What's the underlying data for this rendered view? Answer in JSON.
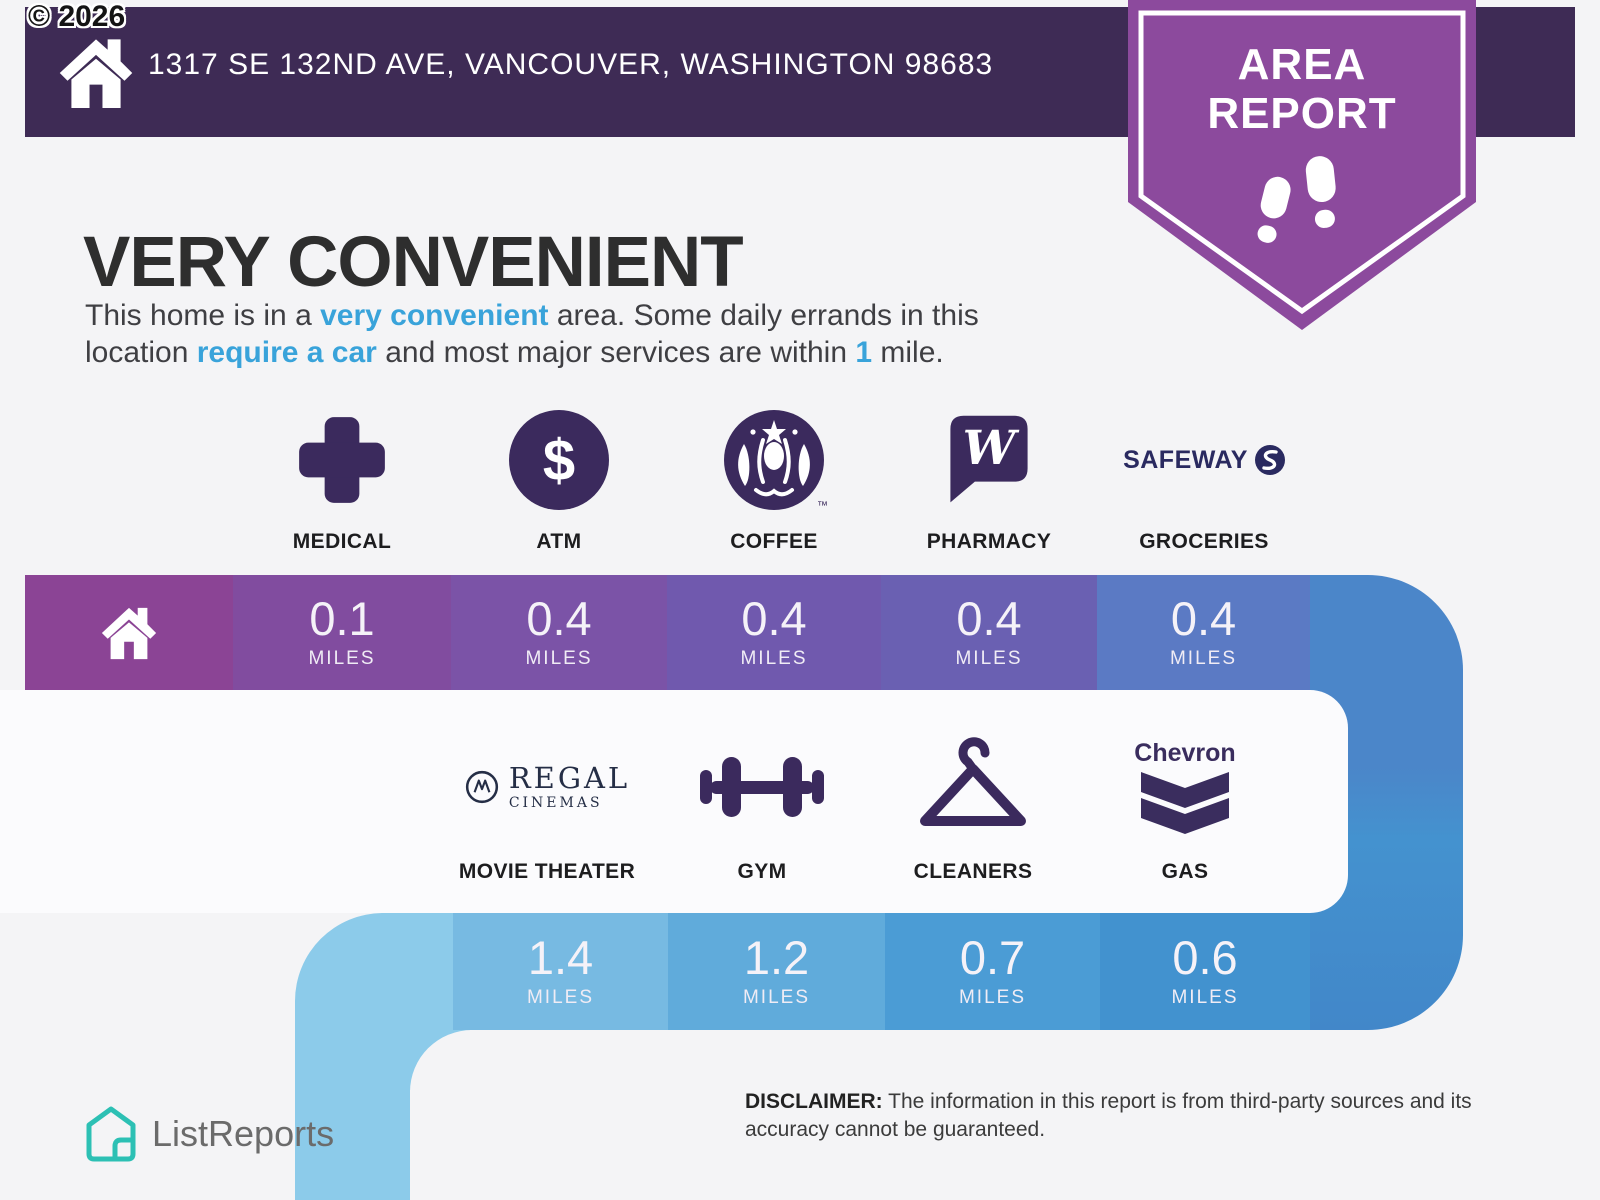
{
  "copyright": "© 2026",
  "header": {
    "address": "1317 SE 132ND AVE, VANCOUVER, WASHINGTON 98683"
  },
  "badge": {
    "line1": "AREA",
    "line2": "REPORT"
  },
  "main": {
    "title": "VERY CONVENIENT",
    "description": {
      "p1": "This home is in a ",
      "hl1": "very convenient",
      "p2": " area. Some daily errands in this",
      "p3": "location ",
      "hl2": "require a car",
      "p4": " and most major services are within ",
      "hl3": "1",
      "p5": " mile."
    }
  },
  "row1": {
    "home_cell_color": "#8b4495",
    "items": [
      {
        "label": "MEDICAL",
        "value": "0.1",
        "unit": "MILES",
        "icon": "medical-cross-icon",
        "cell_color": "#814c9f"
      },
      {
        "label": "ATM",
        "value": "0.4",
        "unit": "MILES",
        "icon": "dollar-circle-icon",
        "cell_color": "#7b53a7"
      },
      {
        "label": "COFFEE",
        "value": "0.4",
        "unit": "MILES",
        "icon": "starbucks-siren-icon",
        "cell_color": "#7059ae"
      },
      {
        "label": "PHARMACY",
        "value": "0.4",
        "unit": "MILES",
        "icon": "walgreens-w-icon",
        "cell_color": "#6a60b2"
      },
      {
        "label": "GROCERIES",
        "value": "0.4",
        "unit": "MILES",
        "icon": "safeway-logo-icon",
        "cell_color": "#5b7ac4"
      }
    ]
  },
  "row2": {
    "corner_color": "#8ccbea",
    "items": [
      {
        "label": "MOVIE THEATER",
        "value": "1.4",
        "unit": "MILES",
        "icon": "regal-cinemas-logo-icon",
        "cell_color": "#77bae2"
      },
      {
        "label": "GYM",
        "value": "1.2",
        "unit": "MILES",
        "icon": "dumbbell-icon",
        "cell_color": "#60abdb"
      },
      {
        "label": "CLEANERS",
        "value": "0.7",
        "unit": "MILES",
        "icon": "clothes-hanger-icon",
        "cell_color": "#4b9cd5"
      },
      {
        "label": "GAS",
        "value": "0.6",
        "unit": "MILES",
        "icon": "chevron-logo-icon",
        "cell_color": "#4292cf"
      }
    ]
  },
  "brands": {
    "safeway": "SAFEWAY",
    "walgreens_w": "W",
    "regal1": "REGAL",
    "regal2": "CINEMAS",
    "chevron": "Chevron",
    "starbucks_tm": "™",
    "dollar": "$"
  },
  "footer": {
    "logo_text": "ListReports",
    "disclaimer_label": "DISCLAIMER:",
    "disclaimer_line1": " The information in this report is from third-party sources and its",
    "disclaimer_line2": "accuracy cannot be guaranteed."
  },
  "colors": {
    "header_bar": "#3e2b55",
    "badge_purple": "#8c4a9d",
    "accent_blue": "#39a3da",
    "icon_purple": "#3b2a5d",
    "path_turn": "#4b86c9",
    "page_bg": "#f4f4f6"
  }
}
